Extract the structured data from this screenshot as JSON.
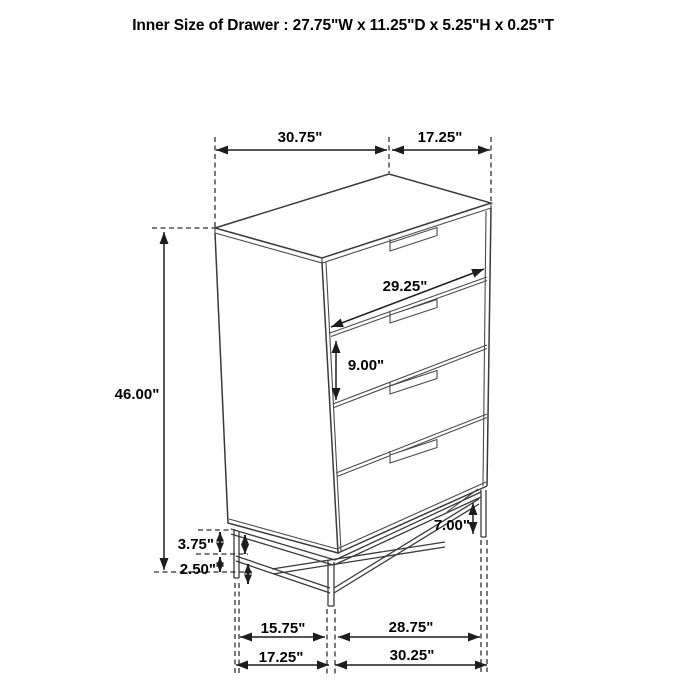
{
  "title": "Inner Size of Drawer : 27.75\"W x 11.25\"D x 5.25\"H x 0.25\"T",
  "colors": {
    "ink": "#3a3a3a",
    "text": "#000000",
    "background": "#ffffff"
  },
  "diagram": {
    "subject": "four-drawer chest dimension drawing",
    "drawer_count": 4,
    "dims": {
      "top_width": "30.75\"",
      "top_depth": "17.25\"",
      "drawer_width": "29.25\"",
      "drawer_height": "9.00\"",
      "overall_height": "46.00\"",
      "base_upper_gap": "3.75\"",
      "base_lower_gap": "2.50\"",
      "base_height": "7.00\"",
      "feet_inner_depth": "15.75\"",
      "feet_inner_width": "28.75\"",
      "feet_outer_depth": "17.25\"",
      "feet_outer_width": "30.25\""
    }
  }
}
